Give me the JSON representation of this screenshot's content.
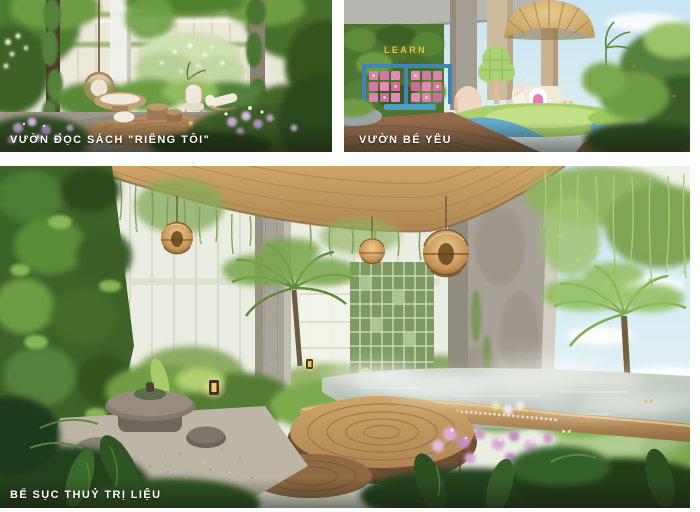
{
  "page": {
    "background": "#ffffff"
  },
  "collage": {
    "panels": [
      {
        "id": "reading-garden",
        "caption": "VƯỜN ĐỌC SÁCH \"RIÊNG TÔI\""
      },
      {
        "id": "kids-garden",
        "caption": "VƯỜN BÉ YÊU",
        "sign_text": "LEARN"
      },
      {
        "id": "hydrotherapy-pool",
        "caption": "BỂ SỤC THUỶ TRỊ LIỆU"
      }
    ],
    "caption_color": "#ffffff",
    "colors": {
      "learn_sign_text": "#e9c93e",
      "learn_frame_blue": "#3f86b6",
      "activity_panel_pink": "#e07fb0",
      "wood_ceiling": "#c49a5f",
      "foliage_green": "#4e7c30",
      "sky_blue": "#cdeaf8",
      "pool_water": "#a9b8ae",
      "deck_wood": "#b98a55",
      "flower_lilac": "#c9a3cf"
    }
  }
}
